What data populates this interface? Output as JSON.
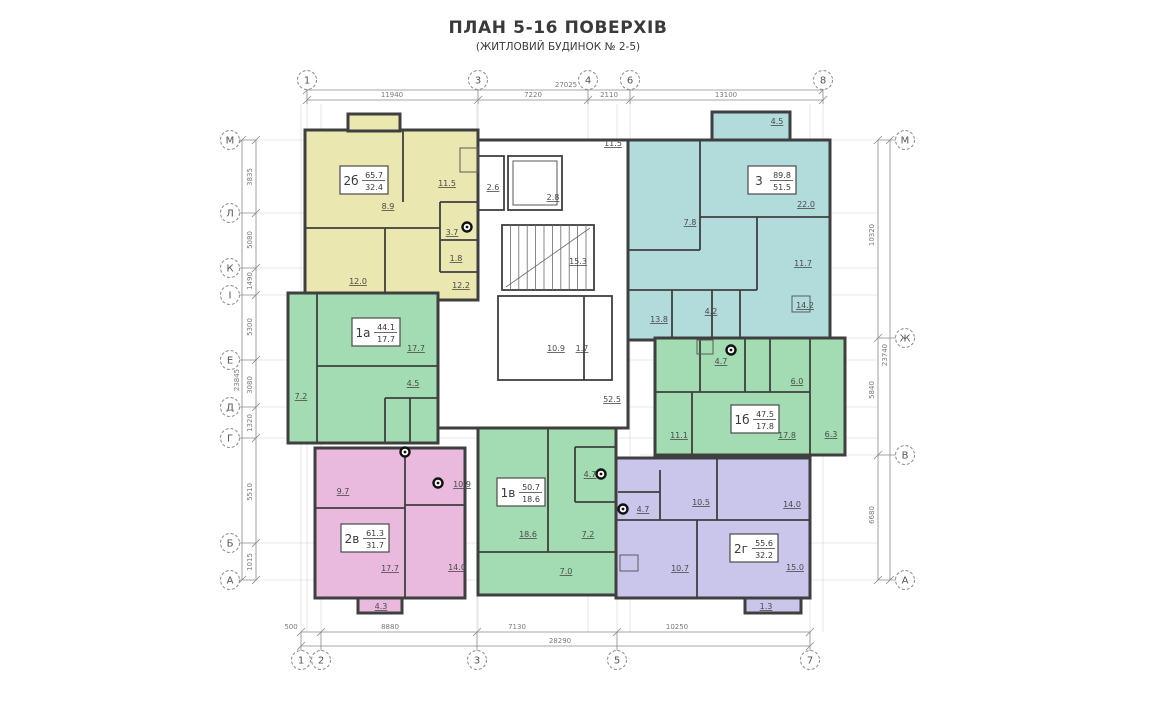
{
  "title": {
    "main": "ПЛАН 5-16 ПОВЕРХІВ",
    "sub": "(ЖИТЛОВИЙ БУДИНОК № 2-5)"
  },
  "colors": {
    "yellow": "#eae7b0",
    "teal": "#b2dcdc",
    "green": "#a3dcb3",
    "pink": "#eab9de",
    "purple": "#cac5eb",
    "wall": "#3f3f3f"
  },
  "apartments": [
    {
      "id": "2b",
      "tag": "2б",
      "total": "65.7",
      "living": "32.4",
      "colorKey": "yellow",
      "box": [
        340,
        166
      ],
      "rooms": [
        {
          "t": "11.5",
          "x": 447,
          "y": 186
        },
        {
          "t": "8.9",
          "x": 388,
          "y": 209
        },
        {
          "t": "3.7",
          "x": 452,
          "y": 235
        },
        {
          "t": "1.8",
          "x": 456,
          "y": 261
        },
        {
          "t": "12.0",
          "x": 358,
          "y": 284
        },
        {
          "t": "12.2",
          "x": 461,
          "y": 288
        }
      ]
    },
    {
      "id": "3",
      "tag": "3",
      "total": "89.8",
      "living": "51.5",
      "colorKey": "teal",
      "box": [
        748,
        166
      ],
      "rooms": [
        {
          "t": "4.5",
          "x": 777,
          "y": 124
        },
        {
          "t": "11.5",
          "x": 613,
          "y": 146
        },
        {
          "t": "22.0",
          "x": 806,
          "y": 207
        },
        {
          "t": "7.8",
          "x": 690,
          "y": 225
        },
        {
          "t": "11.7",
          "x": 803,
          "y": 266
        },
        {
          "t": "4.2",
          "x": 711,
          "y": 314
        },
        {
          "t": "13.8",
          "x": 659,
          "y": 322
        },
        {
          "t": "14.2",
          "x": 805,
          "y": 308
        }
      ]
    },
    {
      "id": "1a",
      "tag": "1а",
      "total": "44.1",
      "living": "17.7",
      "colorKey": "green",
      "box": [
        352,
        318
      ],
      "rooms": [
        {
          "t": "17.7",
          "x": 416,
          "y": 351
        },
        {
          "t": "4.5",
          "x": 413,
          "y": 386
        },
        {
          "t": "7.2",
          "x": 301,
          "y": 399
        }
      ]
    },
    {
      "id": "1b",
      "tag": "1б",
      "total": "47.5",
      "living": "17.8",
      "colorKey": "green",
      "box": [
        731,
        405
      ],
      "rooms": [
        {
          "t": "4.7",
          "x": 721,
          "y": 364
        },
        {
          "t": "6.0",
          "x": 797,
          "y": 384
        },
        {
          "t": "11.1",
          "x": 679,
          "y": 438
        },
        {
          "t": "17.8",
          "x": 787,
          "y": 438
        },
        {
          "t": "6.3",
          "x": 831,
          "y": 437
        }
      ]
    },
    {
      "id": "2v",
      "tag": "2в",
      "total": "61.3",
      "living": "31.7",
      "colorKey": "pink",
      "box": [
        341,
        524
      ],
      "rooms": [
        {
          "t": "9.7",
          "x": 343,
          "y": 494
        },
        {
          "t": "10.9",
          "x": 462,
          "y": 487
        },
        {
          "t": "17.7",
          "x": 390,
          "y": 571
        },
        {
          "t": "14.0",
          "x": 457,
          "y": 570
        },
        {
          "t": "4.3",
          "x": 381,
          "y": 609
        }
      ]
    },
    {
      "id": "1v",
      "tag": "1в",
      "total": "50.7",
      "living": "18.6",
      "colorKey": "green",
      "box": [
        497,
        478
      ],
      "rooms": [
        {
          "t": "4.7",
          "x": 590,
          "y": 477
        },
        {
          "t": "18.6",
          "x": 528,
          "y": 537
        },
        {
          "t": "7.2",
          "x": 588,
          "y": 537
        },
        {
          "t": "7.0",
          "x": 566,
          "y": 574
        }
      ]
    },
    {
      "id": "2g",
      "tag": "2г",
      "total": "55.6",
      "living": "32.2",
      "colorKey": "purple",
      "box": [
        730,
        534
      ],
      "rooms": [
        {
          "t": "4.7",
          "x": 643,
          "y": 512
        },
        {
          "t": "10.5",
          "x": 701,
          "y": 505
        },
        {
          "t": "14.0",
          "x": 792,
          "y": 507
        },
        {
          "t": "10.7",
          "x": 680,
          "y": 571
        },
        {
          "t": "15.0",
          "x": 795,
          "y": 570
        },
        {
          "t": "1.3",
          "x": 766,
          "y": 609
        }
      ]
    }
  ],
  "core": {
    "rooms": [
      {
        "t": "2.6",
        "x": 493,
        "y": 190
      },
      {
        "t": "2.8",
        "x": 553,
        "y": 200
      },
      {
        "t": "15.3",
        "x": 578,
        "y": 264
      },
      {
        "t": "10.9",
        "x": 556,
        "y": 351
      },
      {
        "t": "1.7",
        "x": 582,
        "y": 351
      },
      {
        "t": "52.5",
        "x": 612,
        "y": 402
      }
    ]
  },
  "axes": {
    "top": {
      "y": 80,
      "items": [
        {
          "n": "1",
          "x": 307
        },
        {
          "n": "3",
          "x": 478
        },
        {
          "n": "4",
          "x": 588
        },
        {
          "n": "6",
          "x": 630
        },
        {
          "n": "8",
          "x": 823
        }
      ]
    },
    "bottom": {
      "y": 660,
      "items": [
        {
          "n": "1",
          "x": 301
        },
        {
          "n": "2",
          "x": 321
        },
        {
          "n": "3",
          "x": 477
        },
        {
          "n": "5",
          "x": 617
        },
        {
          "n": "7",
          "x": 810
        }
      ]
    },
    "left": {
      "x": 230,
      "items": [
        {
          "n": "М",
          "y": 140
        },
        {
          "n": "Л",
          "y": 213
        },
        {
          "n": "К",
          "y": 268
        },
        {
          "n": "І",
          "y": 295
        },
        {
          "n": "Е",
          "y": 360
        },
        {
          "n": "Д",
          "y": 407
        },
        {
          "n": "Г",
          "y": 438
        },
        {
          "n": "Б",
          "y": 543
        },
        {
          "n": "А",
          "y": 580
        }
      ]
    },
    "right": {
      "x": 905,
      "items": [
        {
          "n": "М",
          "y": 140
        },
        {
          "n": "Ж",
          "y": 338
        },
        {
          "n": "В",
          "y": 455
        },
        {
          "n": "А",
          "y": 580
        }
      ]
    }
  },
  "dims": {
    "top": {
      "labels": [
        {
          "t": "11940",
          "x": 392
        },
        {
          "t": "7220",
          "x": 533
        },
        {
          "t": "2110",
          "x": 609
        },
        {
          "t": "13100",
          "x": 726
        }
      ],
      "overall": {
        "t": "27025",
        "x": 566
      }
    },
    "bottom": {
      "labels": [
        {
          "t": "500",
          "x": 291
        },
        {
          "t": "8880",
          "x": 390
        },
        {
          "t": "7130",
          "x": 517
        },
        {
          "t": "10250",
          "x": 677
        }
      ],
      "overall": {
        "t": "28290",
        "x": 560
      }
    },
    "left": {
      "labels": [
        {
          "t": "3835",
          "y": 177
        },
        {
          "t": "5080",
          "y": 240
        },
        {
          "t": "1490",
          "y": 281
        },
        {
          "t": "5300",
          "y": 327
        },
        {
          "t": "3080",
          "y": 385
        },
        {
          "t": "1320",
          "y": 423
        },
        {
          "t": "5510",
          "y": 492
        },
        {
          "t": "1015",
          "y": 562
        }
      ],
      "overall": {
        "t": "23845",
        "y": 380
      }
    },
    "right": {
      "labels": [
        {
          "t": "10320",
          "y": 235
        },
        {
          "t": "5840",
          "y": 390
        },
        {
          "t": "6680",
          "y": 515
        }
      ],
      "overall": {
        "t": "23740",
        "y": 355
      }
    }
  }
}
